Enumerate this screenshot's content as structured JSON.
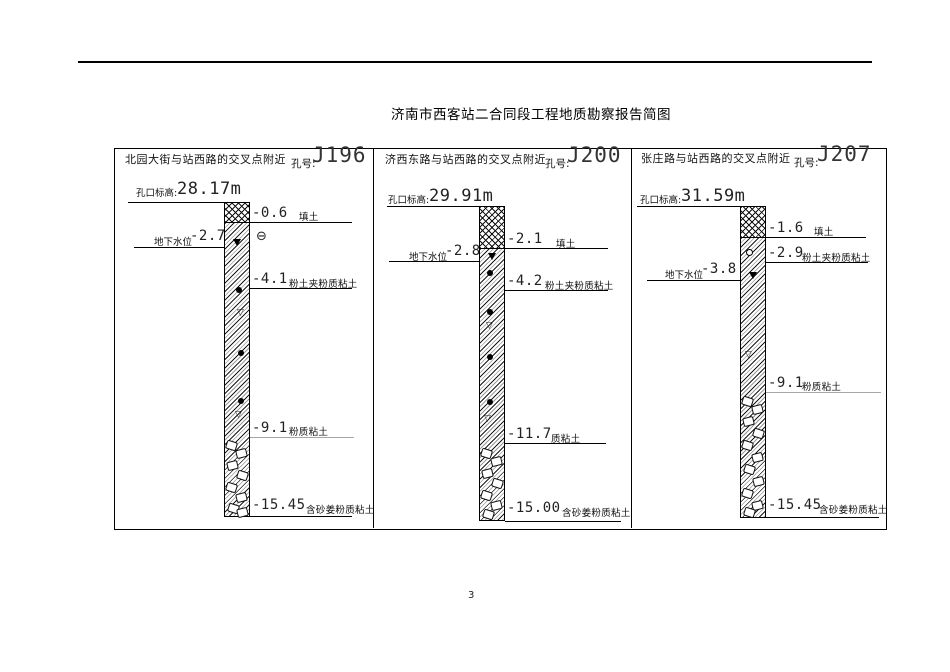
{
  "page": {
    "title": "济南市西客站二合同段工程地质勘察报告简图",
    "page_number": "3"
  },
  "panels": [
    {
      "location": "北园大街与站西路的交叉点附近",
      "hole_label": "孔号:",
      "hole_number": "J196",
      "elevation_label": "孔口标高:",
      "elevation_value": "28.17m",
      "groundwater_label": "地下水位",
      "groundwater_depth": "-2.7",
      "extra_symbol": "⊖",
      "layers": [
        {
          "depth": "-0.6",
          "soil": "填土"
        },
        {
          "depth": "-4.1",
          "soil": "粉土夹粉质粘土"
        },
        {
          "depth": "-9.1",
          "soil": "粉质粘土"
        },
        {
          "depth": "-15.45",
          "soil": "含砂姜粉质粘土"
        }
      ]
    },
    {
      "location": "济西东路与站西路的交叉点附近",
      "hole_label": "孔号:",
      "hole_number": "J200",
      "elevation_label": "孔口标高:",
      "elevation_value": "29.91m",
      "groundwater_label": "地下水位",
      "groundwater_depth": "-2.8",
      "layers": [
        {
          "depth": "-2.1",
          "soil": "填土"
        },
        {
          "depth": "-4.2",
          "soil": "粉土夹粉质粘土"
        },
        {
          "depth": "-11.7",
          "soil": "质粘土"
        },
        {
          "depth": "-15.00",
          "soil": "含砂姜粉质粘土"
        }
      ]
    },
    {
      "location": "张庄路与站西路的交叉点附近",
      "hole_label": "孔号:",
      "hole_number": "J207",
      "elevation_label": "孔口标高:",
      "elevation_value": "31.59m",
      "groundwater_label": "地下水位",
      "groundwater_depth": "-3.8",
      "layers": [
        {
          "depth": "-1.6",
          "soil": "填土"
        },
        {
          "depth": "-2.9",
          "soil": "粉土夹粉质粘土"
        },
        {
          "depth": "-9.1",
          "soil": "粉质粘土"
        },
        {
          "depth": "-15.45",
          "soil": "含砂姜粉质粘土"
        }
      ]
    }
  ]
}
